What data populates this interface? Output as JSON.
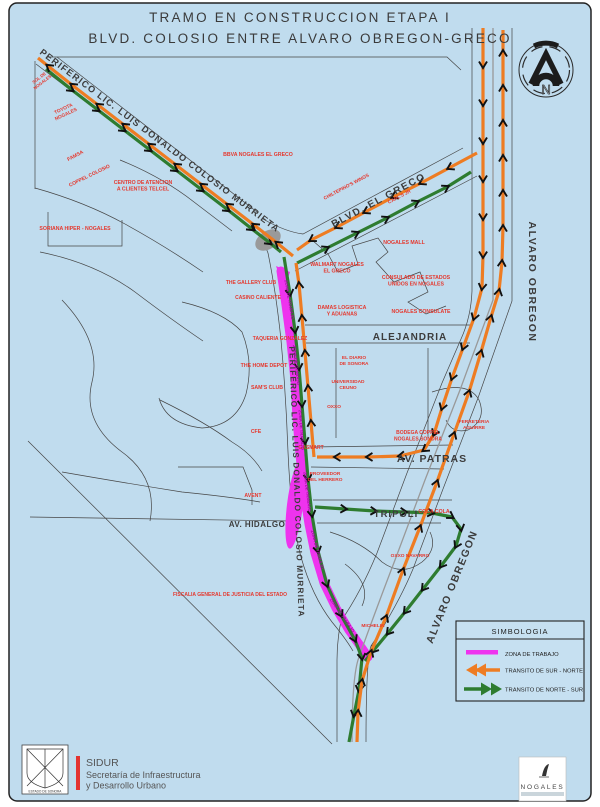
{
  "title": {
    "line1": "TRAMO EN CONSTRUCCION ETAPA I",
    "line2": "BLVD. COLOSIO ENTRE ALVARO OBREGON-GRECO"
  },
  "compass": {
    "north_letter": "N"
  },
  "colors": {
    "background": "#c0dcee",
    "work_zone": "#ee33ee",
    "transit_sur_norte": "#ee7c22",
    "transit_norte_sur": "#2e7c30",
    "poi_label_red": "#e5382e",
    "street_line": "#454545"
  },
  "legend": {
    "title": "SIMBOLOGIA",
    "items": [
      {
        "label": "ZONA DE TRABAJO"
      },
      {
        "label": "TRANSITO DE SUR - NORTE"
      },
      {
        "label": "TRANSITO DE NORTE - SUR"
      }
    ]
  },
  "map": {
    "work_zone_label": "ZONA DE TRABAJO",
    "work_zone_marks": [
      {
        "x": 288,
        "y": 300,
        "rot": 80
      },
      {
        "x": 295,
        "y": 365,
        "rot": 84
      },
      {
        "x": 300,
        "y": 430,
        "rot": 86
      },
      {
        "x": 306,
        "y": 492,
        "rot": 83
      },
      {
        "x": 316,
        "y": 550,
        "rot": 75
      },
      {
        "x": 341,
        "y": 616,
        "rot": 55
      }
    ],
    "street_labels": [
      {
        "text": "PERIFERICO LIC. LUIS DONALDO COLOSIO MURRIETA",
        "x": 158,
        "y": 143,
        "rot": 37,
        "size": 9.2,
        "ls": 1.2
      },
      {
        "text": "BLVD. EL GRECO",
        "x": 380,
        "y": 203,
        "rot": -28,
        "size": 10,
        "ls": 1.5
      },
      {
        "text": "ALVARO OBREGON",
        "x": 529,
        "y": 282,
        "rot": 90,
        "size": 10.5,
        "ls": 1.5
      },
      {
        "text": "ALVARO OBREGON",
        "x": 455,
        "y": 588,
        "rot": -68,
        "size": 10.5,
        "ls": 1.5
      },
      {
        "text": "PERIFERICO LIC. LUIS DONALDO COLOSIO MURRIETA",
        "x": 294,
        "y": 482,
        "rot": 88,
        "size": 8.2,
        "ls": 1.2
      },
      {
        "text": "ALEJANDRIA",
        "x": 410,
        "y": 340,
        "rot": 0,
        "size": 10,
        "ls": 1
      },
      {
        "text": "AV. PATRAS",
        "x": 432,
        "y": 462,
        "rot": 0,
        "size": 10.5,
        "ls": 1
      },
      {
        "text": "TRIPOLI",
        "x": 396,
        "y": 517,
        "rot": 0,
        "size": 9.5,
        "ls": 1
      },
      {
        "text": "AV. HIDALGO",
        "x": 257,
        "y": 527,
        "rot": 0,
        "size": 8,
        "ls": 0.5
      }
    ],
    "poi_labels": [
      {
        "lines": [
          "SOL DE",
          "NOGALES"
        ],
        "x": 40,
        "y": 79,
        "rot": -38,
        "size": 4.3
      },
      {
        "lines": [
          "TOYOTA",
          "NOGALES"
        ],
        "x": 64,
        "y": 110,
        "rot": -25,
        "size": 4.8
      },
      {
        "lines": [
          "FAMSA"
        ],
        "x": 76,
        "y": 157,
        "rot": -28,
        "size": 5
      },
      {
        "lines": [
          "COPPEL COLOSIO"
        ],
        "x": 90,
        "y": 177,
        "rot": -26,
        "size": 5
      },
      {
        "lines": [
          "CENTRO DE ATENCION",
          "A CLIENTES TELCEL"
        ],
        "x": 143,
        "y": 184,
        "rot": 0,
        "size": 5.2
      },
      {
        "lines": [
          "SORIANA HIPER - NOGALES"
        ],
        "x": 75,
        "y": 230,
        "rot": 0,
        "size": 5.2
      },
      {
        "lines": [
          "BBVA NOGALES EL GRECO"
        ],
        "x": 258,
        "y": 156,
        "rot": 0,
        "size": 5.2
      },
      {
        "lines": [
          "CHILTEPINO'S WINGS"
        ],
        "x": 347,
        "y": 188,
        "rot": -28,
        "size": 4.8
      },
      {
        "lines": [
          "CARL'S JR"
        ],
        "x": 400,
        "y": 198,
        "rot": -28,
        "size": 4.8
      },
      {
        "lines": [
          "NOGALES MALL"
        ],
        "x": 404,
        "y": 244,
        "rot": 0,
        "size": 5.2
      },
      {
        "lines": [
          "WALMART NOGALES",
          "EL GRECO"
        ],
        "x": 337,
        "y": 266,
        "rot": 0,
        "size": 5.2
      },
      {
        "lines": [
          "CONSULADO DE ESTADOS",
          "UNIDOS EN NOGALES"
        ],
        "x": 416,
        "y": 279,
        "rot": 0,
        "size": 5.2
      },
      {
        "lines": [
          "DAMAS LOGISTICA",
          "Y ADUANAS"
        ],
        "x": 342,
        "y": 309,
        "rot": 0,
        "size": 5.2
      },
      {
        "lines": [
          "NOGALES CONSULATE"
        ],
        "x": 421,
        "y": 313,
        "rot": 0,
        "size": 5.2
      },
      {
        "lines": [
          "THE GALLERY CLUB"
        ],
        "x": 251,
        "y": 284,
        "rot": 0,
        "size": 5
      },
      {
        "lines": [
          "CASINO CALIENTE"
        ],
        "x": 258,
        "y": 299,
        "rot": 0,
        "size": 5
      },
      {
        "lines": [
          "TAQUERIA GONZALEZ"
        ],
        "x": 280,
        "y": 340,
        "rot": 0,
        "size": 5
      },
      {
        "lines": [
          "THE HOME DEPOT"
        ],
        "x": 264,
        "y": 367,
        "rot": 0,
        "size": 5.2
      },
      {
        "lines": [
          "SAM'S CLUB"
        ],
        "x": 267,
        "y": 389,
        "rot": 0,
        "size": 5.2
      },
      {
        "lines": [
          "CFE"
        ],
        "x": 256,
        "y": 433,
        "rot": 0,
        "size": 5.2
      },
      {
        "lines": [
          "EL DIARIO",
          "DE SONORA"
        ],
        "x": 354,
        "y": 359,
        "rot": 0,
        "size": 4.8
      },
      {
        "lines": [
          "UNIVERSIDAD",
          "CEUNO"
        ],
        "x": 348,
        "y": 383,
        "rot": 0,
        "size": 4.8
      },
      {
        "lines": [
          "OXXO"
        ],
        "x": 334,
        "y": 408,
        "rot": 0,
        "size": 4.8
      },
      {
        "lines": [
          "GASMART"
        ],
        "x": 311,
        "y": 449,
        "rot": 0,
        "size": 5
      },
      {
        "lines": [
          "BODEGA COPPEL",
          "NOGALES SONORA"
        ],
        "x": 418,
        "y": 434,
        "rot": 0,
        "size": 5
      },
      {
        "lines": [
          "FERRETERIA",
          "AGUIRRE"
        ],
        "x": 474,
        "y": 423,
        "rot": 0,
        "size": 4.8
      },
      {
        "lines": [
          "PROVEEDOR",
          "DEL HERRERO"
        ],
        "x": 325,
        "y": 475,
        "rot": 0,
        "size": 4.8
      },
      {
        "lines": [
          "AVENT"
        ],
        "x": 253,
        "y": 497,
        "rot": 0,
        "size": 5.2
      },
      {
        "lines": [
          "COCA COLA"
        ],
        "x": 434,
        "y": 513,
        "rot": 0,
        "size": 5.2
      },
      {
        "lines": [
          "OXXO NAVARRO"
        ],
        "x": 410,
        "y": 557,
        "rot": 0,
        "size": 4.8
      },
      {
        "lines": [
          "FISCALIA GENERAL DE JUSTICIA DEL ESTADO"
        ],
        "x": 230,
        "y": 596,
        "rot": 0,
        "size": 5
      },
      {
        "lines": [
          "MICHELIN"
        ],
        "x": 373,
        "y": 627,
        "rot": 0,
        "size": 4.8
      }
    ]
  },
  "footer": {
    "agency_acronym": "SIDUR",
    "agency_line1": "Secretaría de Infraestructura",
    "agency_line2": "y Desarrollo Urbano",
    "state_seal_caption": "ESTADO DE SONORA",
    "city_logo_text": "NOGALES"
  }
}
